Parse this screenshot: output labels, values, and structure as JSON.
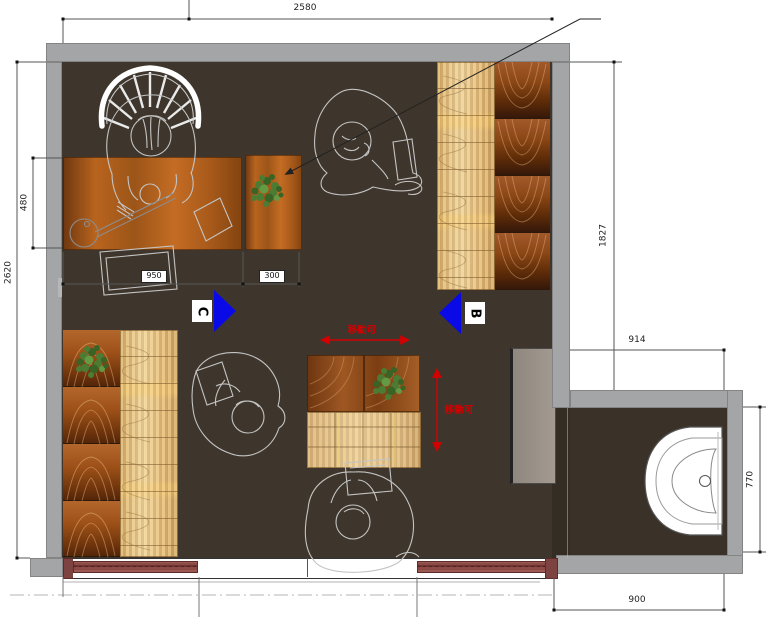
{
  "dims": {
    "top_width": "2580",
    "left_total_height": "2620",
    "desk_depth": "480",
    "desk_width": "950",
    "side_table_width": "300",
    "right_upper_height": "1827",
    "bath_top_width": "914",
    "bath_right_depth": "770",
    "bath_bottom_width": "900"
  },
  "markers": {
    "view_c": "C",
    "view_b": "B"
  },
  "notes": {
    "movable_h": "移動可",
    "movable_v": "移動可"
  },
  "colors": {
    "wall_gray": "#a4a5a7",
    "floor_brown": "#3e362c",
    "marker_blue": "#0a0ae6",
    "annotation_red": "#d40000",
    "door_track_maroon": "#8c4a46",
    "wood_dark": "#8c4716",
    "wood_light": "#eed49f",
    "plant_green": "#4c7c33"
  }
}
